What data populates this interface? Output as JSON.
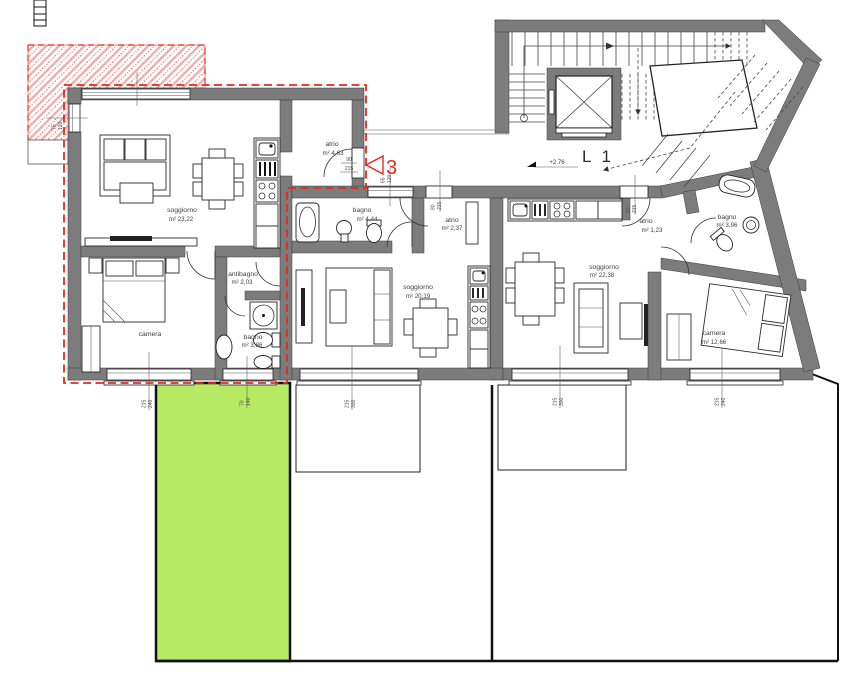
{
  "plan": {
    "stair_core": {
      "level_label": "L 1",
      "elevation_marker": "+2.76"
    },
    "unit_marker": {
      "number": "3",
      "door_width": "90",
      "door_height": "215"
    },
    "rooms": {
      "a3_soggiorno": {
        "name": "soggiorno",
        "area": "m² 23,22"
      },
      "a3_camera": {
        "name": "camera",
        "area": ""
      },
      "a3_antibagno": {
        "name": "antibagno",
        "area": "m² 2,03"
      },
      "a3_bagno": {
        "name": "bagno",
        "area": "m² 3,86"
      },
      "a3_atrio": {
        "name": "atrio",
        "area": "m² 4,63"
      },
      "b_bagno": {
        "name": "bagno",
        "area": "m² 4,44"
      },
      "b_atrio": {
        "name": "atrio",
        "area": "m² 2,37"
      },
      "b_soggiorno": {
        "name": "soggiorno",
        "area": "m² 20,19"
      },
      "c_atrio": {
        "name": "atrio",
        "area": "m² 1,23"
      },
      "c_bagno": {
        "name": "bagno",
        "area": "m² 3,96"
      },
      "c_soggiorno": {
        "name": "soggiorno",
        "area": "m² 22,38"
      },
      "c_camera": {
        "name": "camera",
        "area": "m² 12,66"
      }
    },
    "window_dims": {
      "left_wall": {
        "a": "75",
        "b": "120"
      },
      "corridor_bagno": {
        "a": "65",
        "b": "120"
      },
      "entrance_b": {
        "a": "80",
        "b": "215"
      },
      "entrance_c": {
        "a": "80",
        "b": "215"
      },
      "a3_window_1": {
        "a": "215",
        "b": "240"
      },
      "a3_window_2": {
        "a": "70",
        "b": "140"
      },
      "b_window": {
        "a": "215",
        "b": "300"
      },
      "c_window_1": {
        "a": "215",
        "b": "300"
      },
      "c_window_2": {
        "a": "215",
        "b": "240"
      }
    },
    "colors": {
      "wall_fill": "#7c7c7c",
      "red_accent": "#e8281e",
      "garden_green": "#b7e962",
      "hatch_pink": "#f0a8a4"
    }
  }
}
